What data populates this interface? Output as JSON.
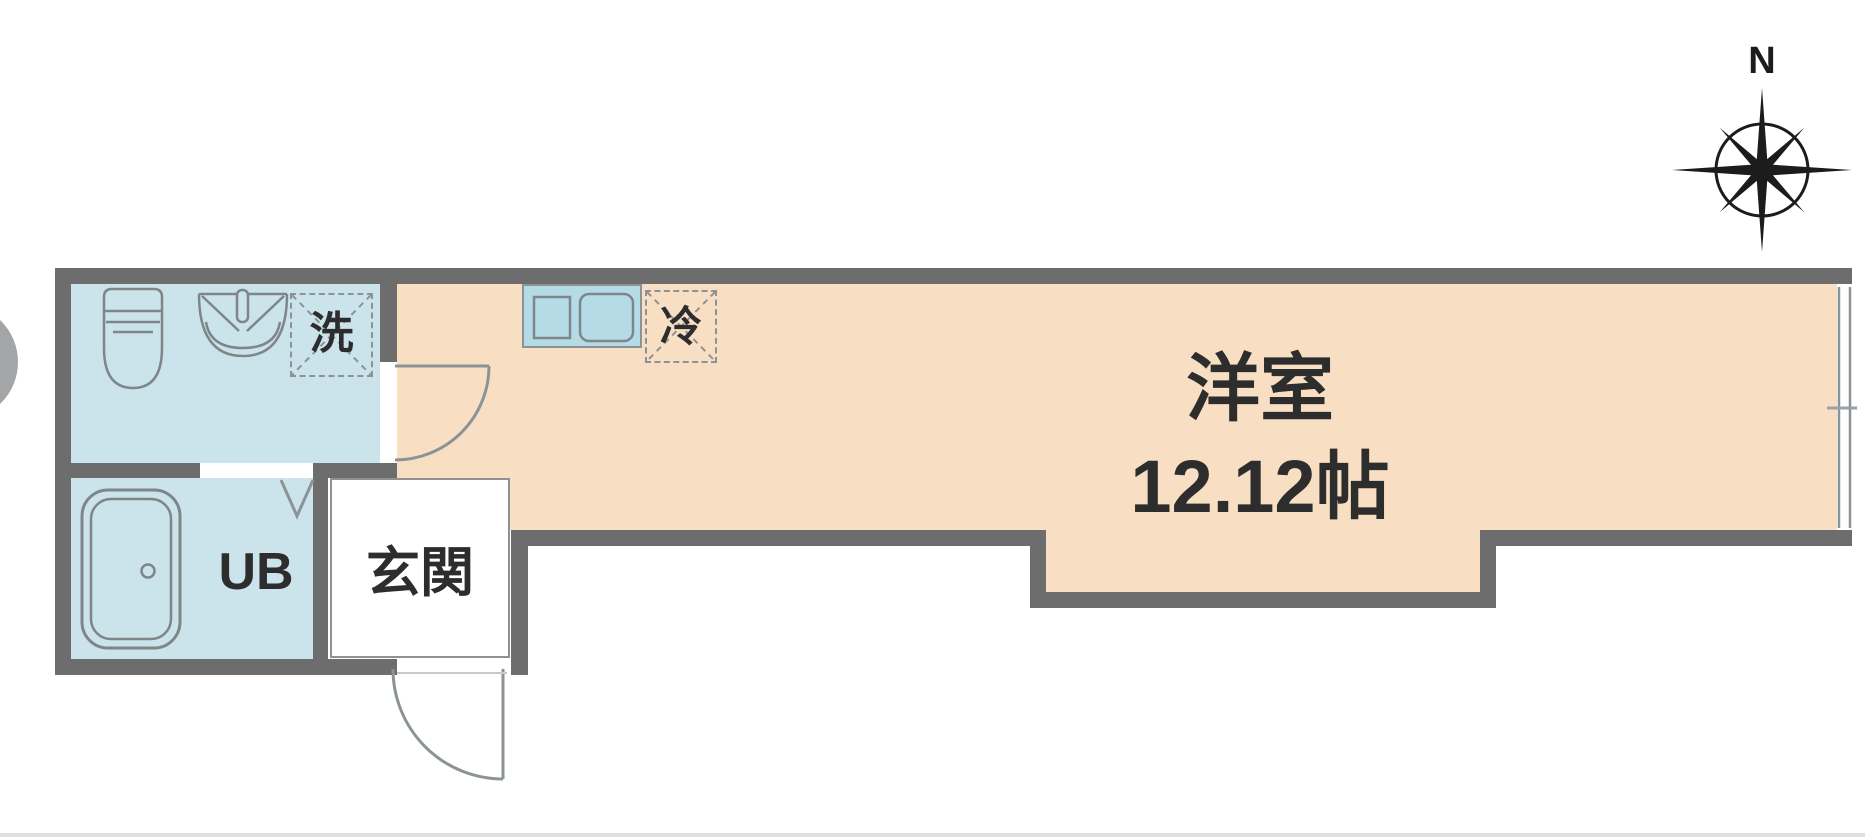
{
  "plan": {
    "title": "floor-plan",
    "labels": {
      "main_room_name": "洋室",
      "main_room_size": "12.12帖",
      "unit_bath": "UB",
      "entrance": "玄関",
      "washing_machine": "洗",
      "refrigerator": "冷",
      "compass_north": "N"
    },
    "colors": {
      "wall": "#6d6d6d",
      "main_room_fill": "#f8dfc4",
      "wet_area_fill": "#cbe4eb",
      "kitchen_counter_fill": "#b5dbe7",
      "fixture_line": "#7e868a",
      "dashed_line": "#8d9296",
      "footer_line": "#dde1e5",
      "text": "#2d2d2d"
    }
  }
}
